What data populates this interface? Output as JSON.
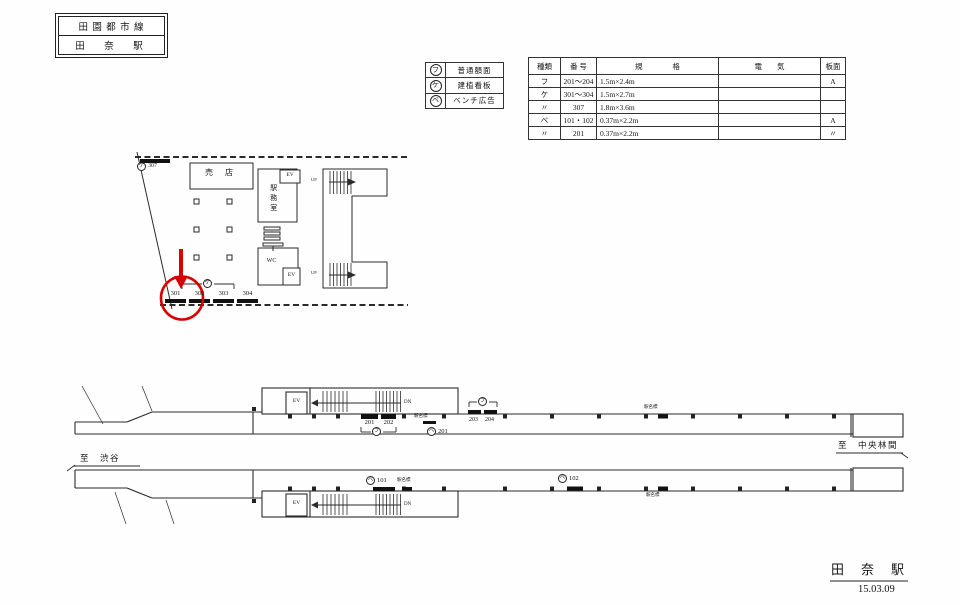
{
  "title_box": {
    "line": "田 園 都 市 線",
    "station": "田　奈　駅"
  },
  "legend": {
    "rows": [
      {
        "symbol": "フ",
        "label": "普通額面"
      },
      {
        "symbol": "ケ",
        "label": "建植看板"
      },
      {
        "symbol": "ベ",
        "label": "ベンチ広告"
      }
    ]
  },
  "spec_table": {
    "headers": {
      "type": "種類",
      "number": "番 号",
      "spec": "規　　　　格",
      "electric": "電　　気",
      "board": "板面"
    },
    "rows": [
      {
        "type": "フ",
        "number": "201〜204",
        "spec": "1.5m×2.4m",
        "electric": "",
        "board": "A"
      },
      {
        "type": "ケ",
        "number": "301〜304",
        "spec": "1.5m×2.7m",
        "electric": "",
        "board": ""
      },
      {
        "type": "〃",
        "number": "307",
        "spec": "1.8m×3.6m",
        "electric": "",
        "board": ""
      },
      {
        "type": "ベ",
        "number": "101・102",
        "spec": "0.37m×2.2m",
        "electric": "",
        "board": "A"
      },
      {
        "type": "〃",
        "number": "201",
        "spec": "0.37m×2.2m",
        "electric": "",
        "board": "〃"
      }
    ]
  },
  "plan": {
    "sign307": {
      "symbol": "ケ",
      "number": "307"
    },
    "shop": "売 店",
    "office": "駅務室",
    "wc": "WC",
    "ev": "EV",
    "up": "UP",
    "bracket_symbol": "ケ",
    "signs": [
      "301",
      "302",
      "303",
      "304"
    ]
  },
  "upper": {
    "ev": "EV",
    "dn": "DN",
    "signs_left": [
      "201",
      "202"
    ],
    "bracket_symbol": "フ",
    "bracket_symbol2": "フ",
    "bench": {
      "symbol": "ベ",
      "number": "201"
    },
    "signs_right": [
      "203",
      "204"
    ],
    "station_sign": "駅名標",
    "to_right": "至　中央林間"
  },
  "lower": {
    "to_left": "至　渋谷",
    "ev": "EV",
    "dn": "DN",
    "bench101": {
      "symbol": "ベ",
      "number": "101"
    },
    "bench102": {
      "symbol": "ベ",
      "number": "102"
    },
    "station_sign": "駅名標"
  },
  "footer": {
    "station": "田　奈　駅",
    "date": "15.03.09"
  }
}
